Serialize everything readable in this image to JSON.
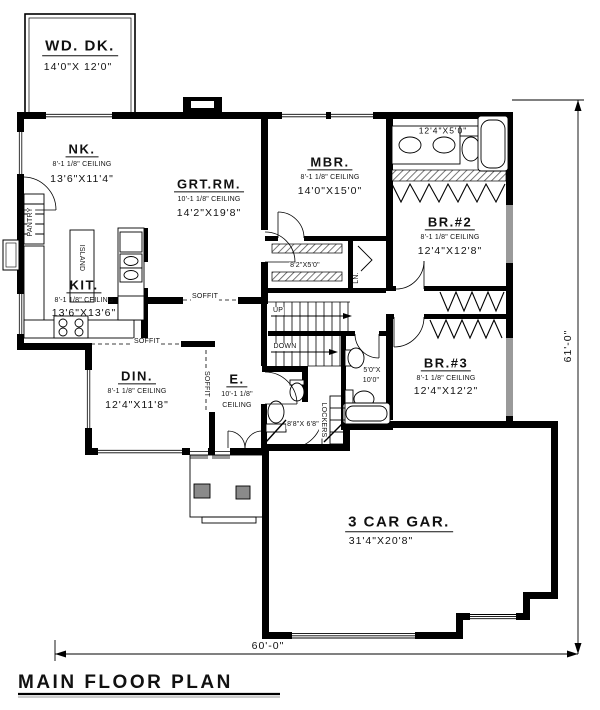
{
  "title": "MAIN FLOOR PLAN",
  "dims": {
    "width": "60'-0\"",
    "height": "61'-0\""
  },
  "rooms": {
    "deck": {
      "name": "WD. DK.",
      "size": "14'0\"X 12'0\""
    },
    "nook": {
      "name": "NK.",
      "ceiling": "8'-1 1/8\" CEILING",
      "size": "13'6\"X11'4\""
    },
    "great": {
      "name": "GRT.RM.",
      "ceiling": "10'-1 1/8\" CEILING",
      "size": "14'2\"X19'8\""
    },
    "master": {
      "name": "MBR.",
      "ceiling": "8'-1 1/8\" CEILING",
      "size": "14'0\"X15'0\""
    },
    "master_bath": {
      "size": "12'4\"X5'0\""
    },
    "bed2": {
      "name": "BR.#2",
      "ceiling": "8'-1 1/8\" CEILING",
      "size": "12'4\"X12'8\""
    },
    "kitchen": {
      "name": "KIT.",
      "ceiling": "8'-1 1/8\" CEILING",
      "size": "13'6\"X13'6\""
    },
    "dining": {
      "name": "DIN.",
      "ceiling": "8'-1 1/8\" CEILING",
      "size": "12'4\"X11'8\""
    },
    "entry": {
      "name": "E.",
      "ceiling_l1": "10'-1 1/8\"",
      "ceiling_l2": "CEILING"
    },
    "closet": {
      "size": "8'2\"X5'0\""
    },
    "hall_bath": {
      "size_l1": "5'0\"X",
      "size_l2": "10'0\""
    },
    "mud": {
      "size": "8'8\"X 6'8\""
    },
    "bed3": {
      "name": "BR.#3",
      "ceiling": "8'-1 1/8\" CEILING",
      "size": "12'4\"X12'2\""
    },
    "garage": {
      "name": "3 CAR GAR.",
      "size": "31'4\"X20'8\""
    }
  },
  "annotations": {
    "pantry": "PANTRY",
    "island": "ISLAND",
    "soffit_great": "SOFFIT",
    "soffit_dining": "SOFFIT",
    "soffit_dining_v": "SOFFIT",
    "up": "UP",
    "down": "DOWN",
    "linen": "LN.",
    "lockers": "LOCKERS"
  },
  "colors": {
    "ink": "#111111",
    "wall": "#000000",
    "hatch_gray": "#9a9a9a"
  }
}
